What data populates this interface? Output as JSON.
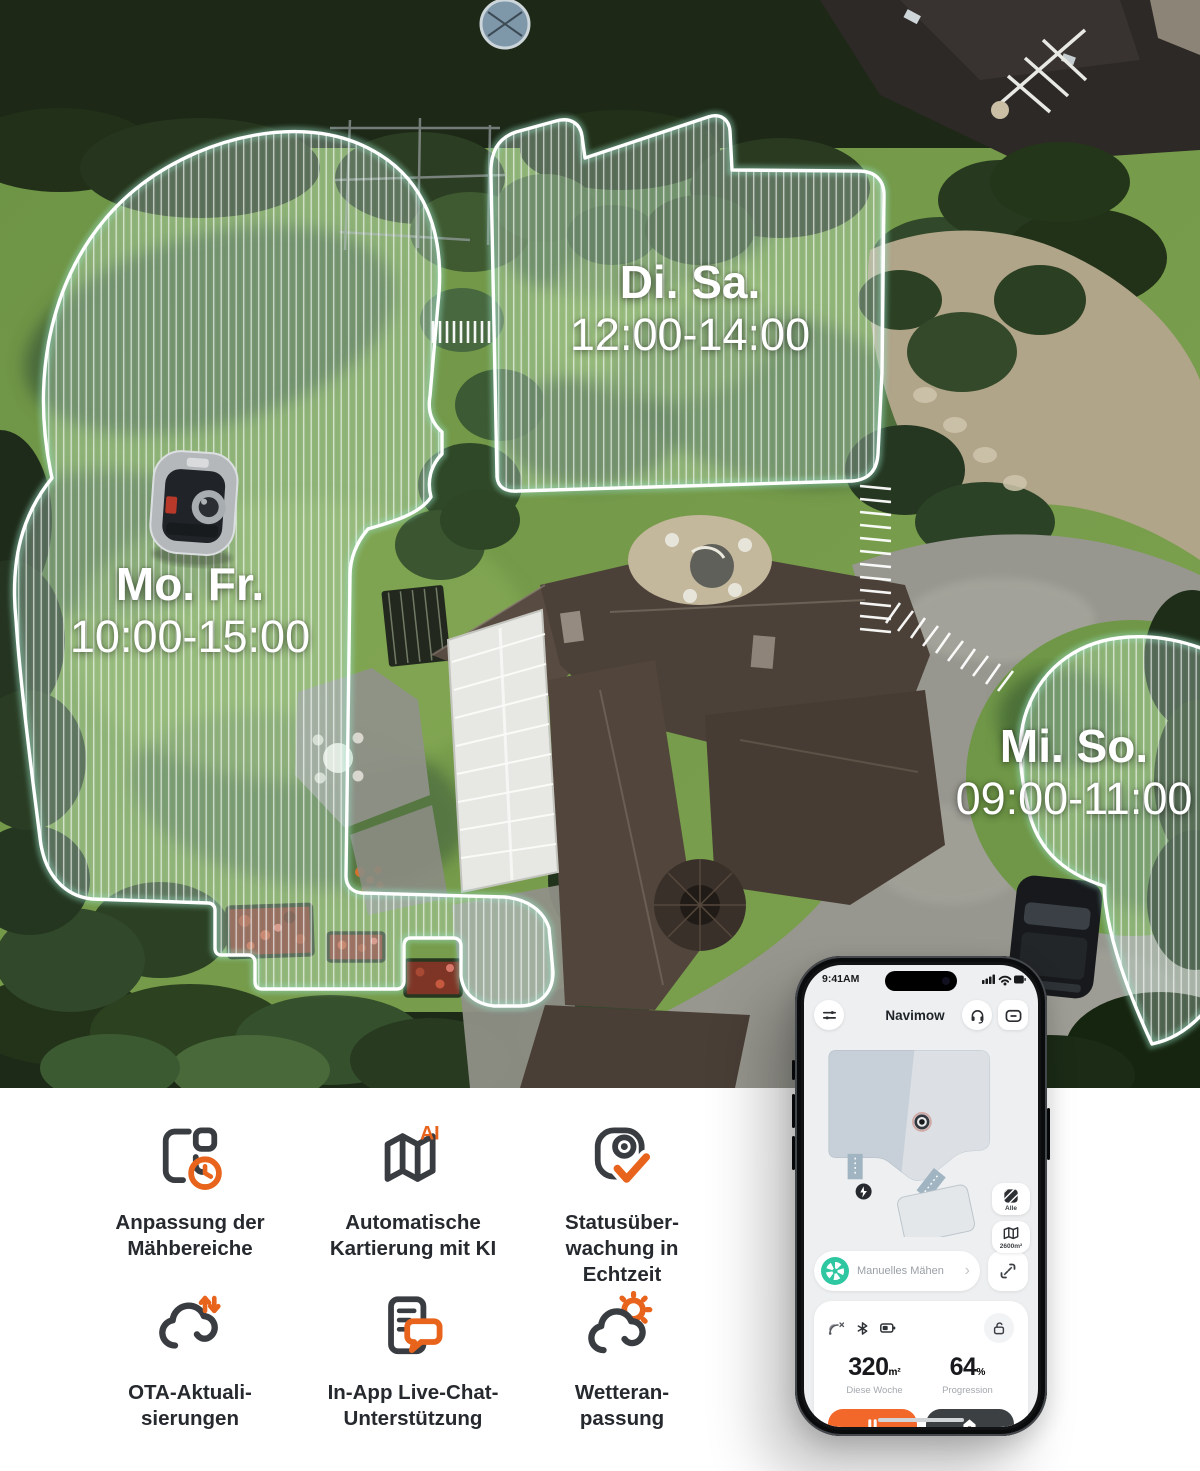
{
  "aerial": {
    "zones": [
      {
        "day": "Mo. Fr.",
        "time": "10:00-15:00"
      },
      {
        "day": "Di. Sa.",
        "time": "12:00-14:00"
      },
      {
        "day": "Mi. So.",
        "time": "09:00-11:00"
      }
    ]
  },
  "phone": {
    "status_time": "9:41AM",
    "app_title": "Navimow",
    "map_controls": {
      "all_label": "Alle",
      "area_label": "2600m²"
    },
    "mode": {
      "label": "Manuelles Mähen",
      "chevron": "›"
    },
    "stats": {
      "week": {
        "value": "320",
        "unit": "m²",
        "label": "Diese Woche"
      },
      "progress": {
        "value": "64",
        "unit": "%",
        "label": "Progression"
      }
    },
    "actions": {
      "stop": "STOP",
      "home": "HOME"
    }
  },
  "features": [
    {
      "icon": "mow-zones-clock-icon",
      "label": "Anpassung der\nMähbereiche"
    },
    {
      "icon": "map-ai-icon",
      "label": "Automatische\nKartierung mit KI"
    },
    {
      "icon": "status-monitor-check-icon",
      "label": "Statusüber-\nwachung in\nEchtzeit"
    },
    {
      "icon": "cloud-ota-icon",
      "label": "OTA-Aktuali-\nsierungen"
    },
    {
      "icon": "chat-support-icon",
      "label": "In-App Live-Chat-\nUnterstützung"
    },
    {
      "icon": "weather-cloud-sun-icon",
      "label": "Wetteran-\npassung"
    }
  ],
  "colors": {
    "accent_orange": "#e8641c",
    "teal": "#2fc7a1",
    "stop_orange": "#f2672a",
    "home_dark": "#3d4043",
    "zone_outline": "#ffffff"
  }
}
